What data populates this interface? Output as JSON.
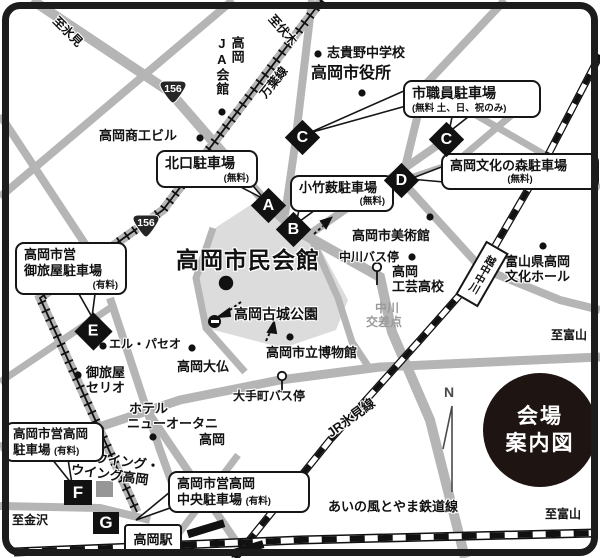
{
  "frame": {
    "badge_line1": "会場",
    "badge_line2": "案内図",
    "compass_n": "N"
  },
  "route_shield": "156",
  "directions": {
    "himi": "至氷見",
    "fushiki": "至伏木",
    "toyama_right": "至富山",
    "toyama_bottom": "至富山",
    "kanazawa": "至金沢"
  },
  "railways": {
    "manyo_line": "万葉線",
    "jr_himi_line": "JR氷見線",
    "ainokaze_line": "あいの風とやま鉄道線",
    "station_etchu_nakagawa": "越中中川",
    "station_takaoka": "高岡駅"
  },
  "places": {
    "ja_hall_col1": "高岡",
    "ja_hall_col2": "JA会館",
    "shoko_building": "高岡商工ビル",
    "shikino_jhs": "志貴野中学校",
    "city_hall": "高岡市役所",
    "art_museum": "高岡市美術館",
    "bunka_hall_line1": "富山県高岡",
    "bunka_hall_line2": "文化ホール",
    "kogei_line1": "高岡",
    "kogei_line2": "工芸高校",
    "nakagawa_bus_stop": "中川バス停",
    "otemachi_bus_stop": "大手町バス停",
    "civic_hall": "高岡市民会館",
    "kojo_park": "高岡古城公園",
    "city_museum": "高岡市立博物館",
    "daibutsu": "高岡大仏",
    "el_paseo": "エル・パセオ",
    "otaya_line1": "御旅屋",
    "otaya_line2": "セリオ",
    "hotel_line1": "ホテル",
    "hotel_line2": "ニューオータニ",
    "hotel_line3": "高岡",
    "wing_line1": "ウイング・",
    "wing_line2": "ウイング高岡",
    "nakagawa_xing_line1": "中川",
    "nakagawa_xing_line2": "交差点"
  },
  "parkings": {
    "kitaguchi": {
      "title": "北口駐車場",
      "note": "(無料)",
      "marker": "A"
    },
    "shishokuin": {
      "title": "市職員駐車場",
      "note": "(無料 土、日、祝のみ)",
      "marker": "C"
    },
    "kotakeyabu": {
      "title": "小竹薮駐車場",
      "note": "(無料)",
      "marker": "B"
    },
    "bunka_mori": {
      "title": "高岡文化の森駐車場",
      "note": "(無料)",
      "marker": "D"
    },
    "otaya": {
      "title_line1": "高岡市営",
      "title_line2": "御旅屋駐車場",
      "note": "(有料)",
      "marker": "E"
    },
    "shiei_takaoka": {
      "title_line1": "高岡市営高岡",
      "title_line2": "駐車場",
      "note": "(有料)",
      "marker": "F"
    },
    "shiei_chuo": {
      "title_line1": "高岡市営高岡",
      "title_line2": "中央駐車場",
      "note": "(有料)",
      "marker": "G"
    }
  },
  "markers": {
    "a": "A",
    "b": "B",
    "c1": "C",
    "c2": "C",
    "d": "D",
    "e": "E",
    "f": "F",
    "g": "G"
  }
}
